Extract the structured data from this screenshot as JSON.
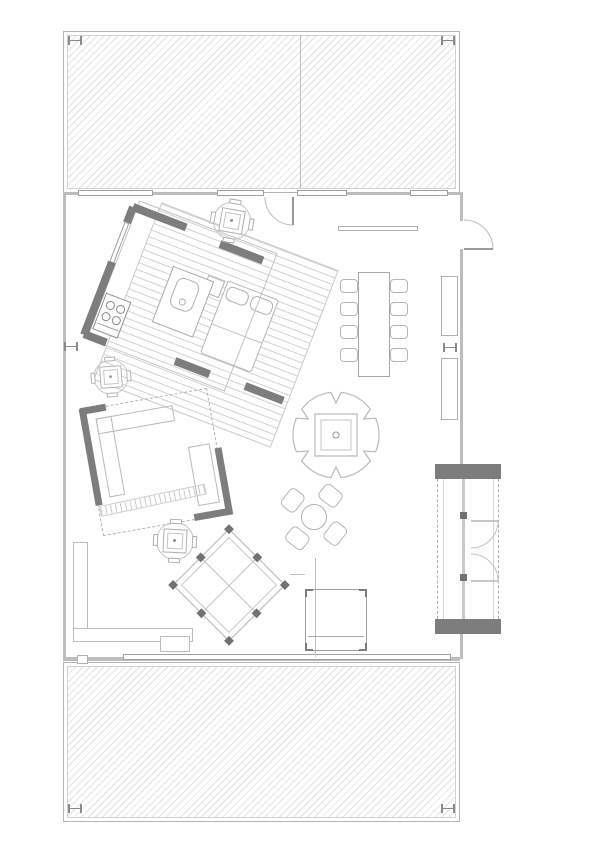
{
  "document": {
    "kind": "architectural floor plan",
    "orientation": "portrait",
    "visible_text": "none"
  },
  "palette": {
    "background": "#ffffff",
    "dark_wall": "#7d7d7d",
    "light_wall": "#bdbdbd",
    "drawing_line": "#b5b5b5",
    "hatch_line": "#e2e2e2",
    "floorboard_line": "#d0d0d0"
  },
  "areas": {
    "upper_deck": "hatched terrace with center seam and corner markers",
    "lower_deck": "hatched terrace with corner markers",
    "main_floor": "open plan living space between decks"
  },
  "elements": {
    "kitchen_pod": "square volume rotated ~21° with dark wall segments, stove, island with sink",
    "kitchen_platform": "larger rotated decking platform with floorboard lines and daybed",
    "lounge_pod": "square volume rotated ~-10° with dashed glass edges, L-sofa and bench",
    "dining_set": {
      "table": 1,
      "chairs": 8
    },
    "cafe_tables": 3,
    "patio_table_chairs": 4,
    "tree_feature": "scalloped circle with double square planter and center dot",
    "diamond_platform": "45° rotated platform with 8 dark posts and cross rails",
    "stair_closet": "right-side block with dark end caps, dashed sides and double doors",
    "wall_shelves_right": 2,
    "corner_cabinet": "bottom-right square cabinet with corner brackets",
    "l_bench": "bottom-left L-shaped counter",
    "ramp_steps": "short hatched diagonal strip",
    "doors": [
      "top entry door with quarter arc",
      "right entry door with quarter arc",
      "closet double doors"
    ]
  }
}
